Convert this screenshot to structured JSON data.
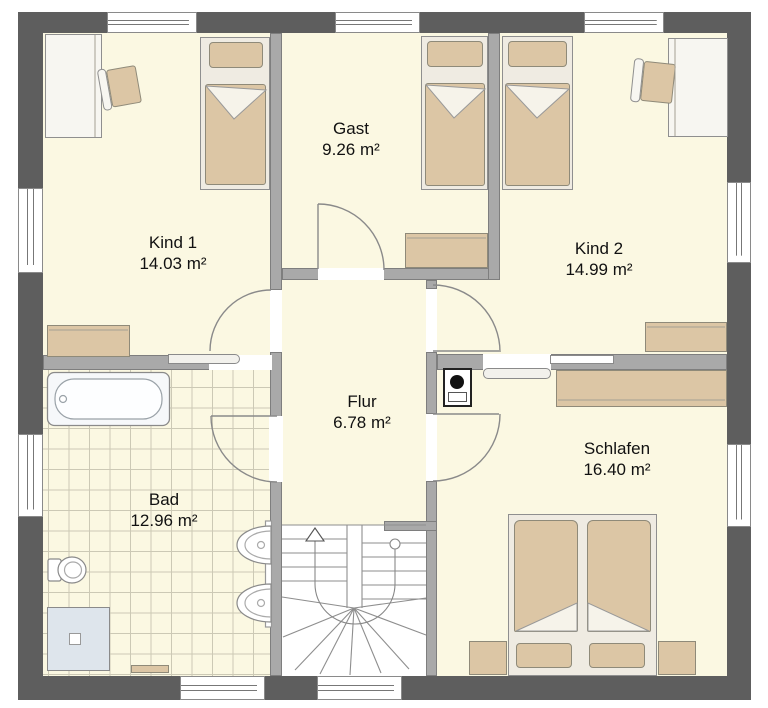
{
  "plan_title": "Obergeschoss Grundriss",
  "rooms": {
    "gast": {
      "name": "Gast",
      "area": "9.26 m²"
    },
    "kind1": {
      "name": "Kind 1",
      "area": "14.03 m²"
    },
    "kind2": {
      "name": "Kind 2",
      "area": "14.99 m²"
    },
    "flur": {
      "name": "Flur",
      "area": "6.78 m²"
    },
    "bad": {
      "name": "Bad",
      "area": "12.96 m²"
    },
    "schlafen": {
      "name": "Schlafen",
      "area": "16.40 m²"
    }
  },
  "colors": {
    "exterior_wall": "#5E5E5E",
    "interior_wall": "#A9A9A9",
    "floor": "#FBF8E2",
    "furniture_beige": "#DCC6A5",
    "fixture_white": "#EFEBE2",
    "shower_blue": "#DEE5EC",
    "tile_line": "#CCC9B5"
  }
}
